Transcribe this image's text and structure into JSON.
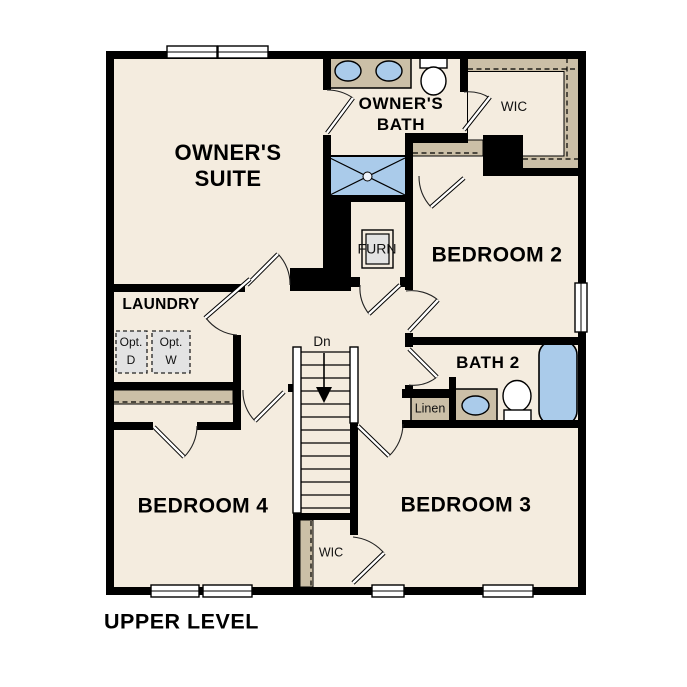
{
  "plan": {
    "title": "UPPER LEVEL",
    "labels": {
      "owners_suite_1": "OWNER'S",
      "owners_suite_2": "SUITE",
      "owners_bath_1": "OWNER'S",
      "owners_bath_2": "BATH",
      "wic_upper": "WIC",
      "bedroom2": "BEDROOM 2",
      "furnace": "FURN",
      "laundry": "LAUNDRY",
      "opt_d_1": "Opt.",
      "opt_d_2": "D",
      "opt_w_1": "Opt.",
      "opt_w_2": "W",
      "stairs_dn": "Dn",
      "bath2": "BATH 2",
      "linen": "Linen",
      "bedroom4": "BEDROOM 4",
      "bedroom3": "BEDROOM 3",
      "wic_lower": "WIC"
    },
    "colors": {
      "floor": "#f4ecdf",
      "wall": "#000000",
      "shelf_tan": "#cbbfa7",
      "fixture_blue": "#aacbea",
      "appliance_gray": "#e3e3e3",
      "window_white": "#ffffff"
    }
  }
}
